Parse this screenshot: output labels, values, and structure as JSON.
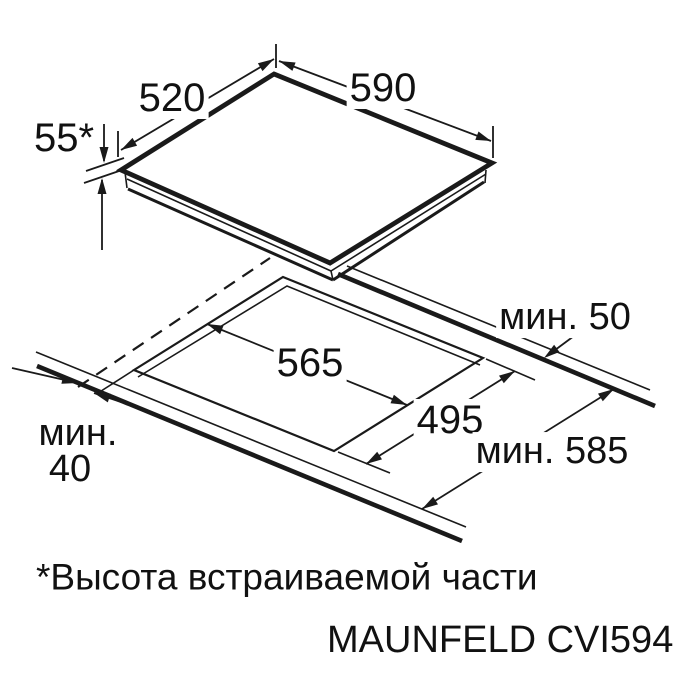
{
  "diagram": {
    "model": "MAUNFELD CVI594",
    "footnote": "*Высота встраиваемой части",
    "dims": {
      "hob_width": "590",
      "hob_depth": "520",
      "built_in_height": "55*",
      "cutout_width": "565",
      "cutout_depth": "495",
      "clearance_rear": "мин. 50",
      "clearance_front_word": "мин.",
      "clearance_front_value": "40",
      "worktop_min_depth": "мин. 585"
    },
    "colors": {
      "line": "#1a1a1a",
      "background": "#ffffff"
    }
  }
}
